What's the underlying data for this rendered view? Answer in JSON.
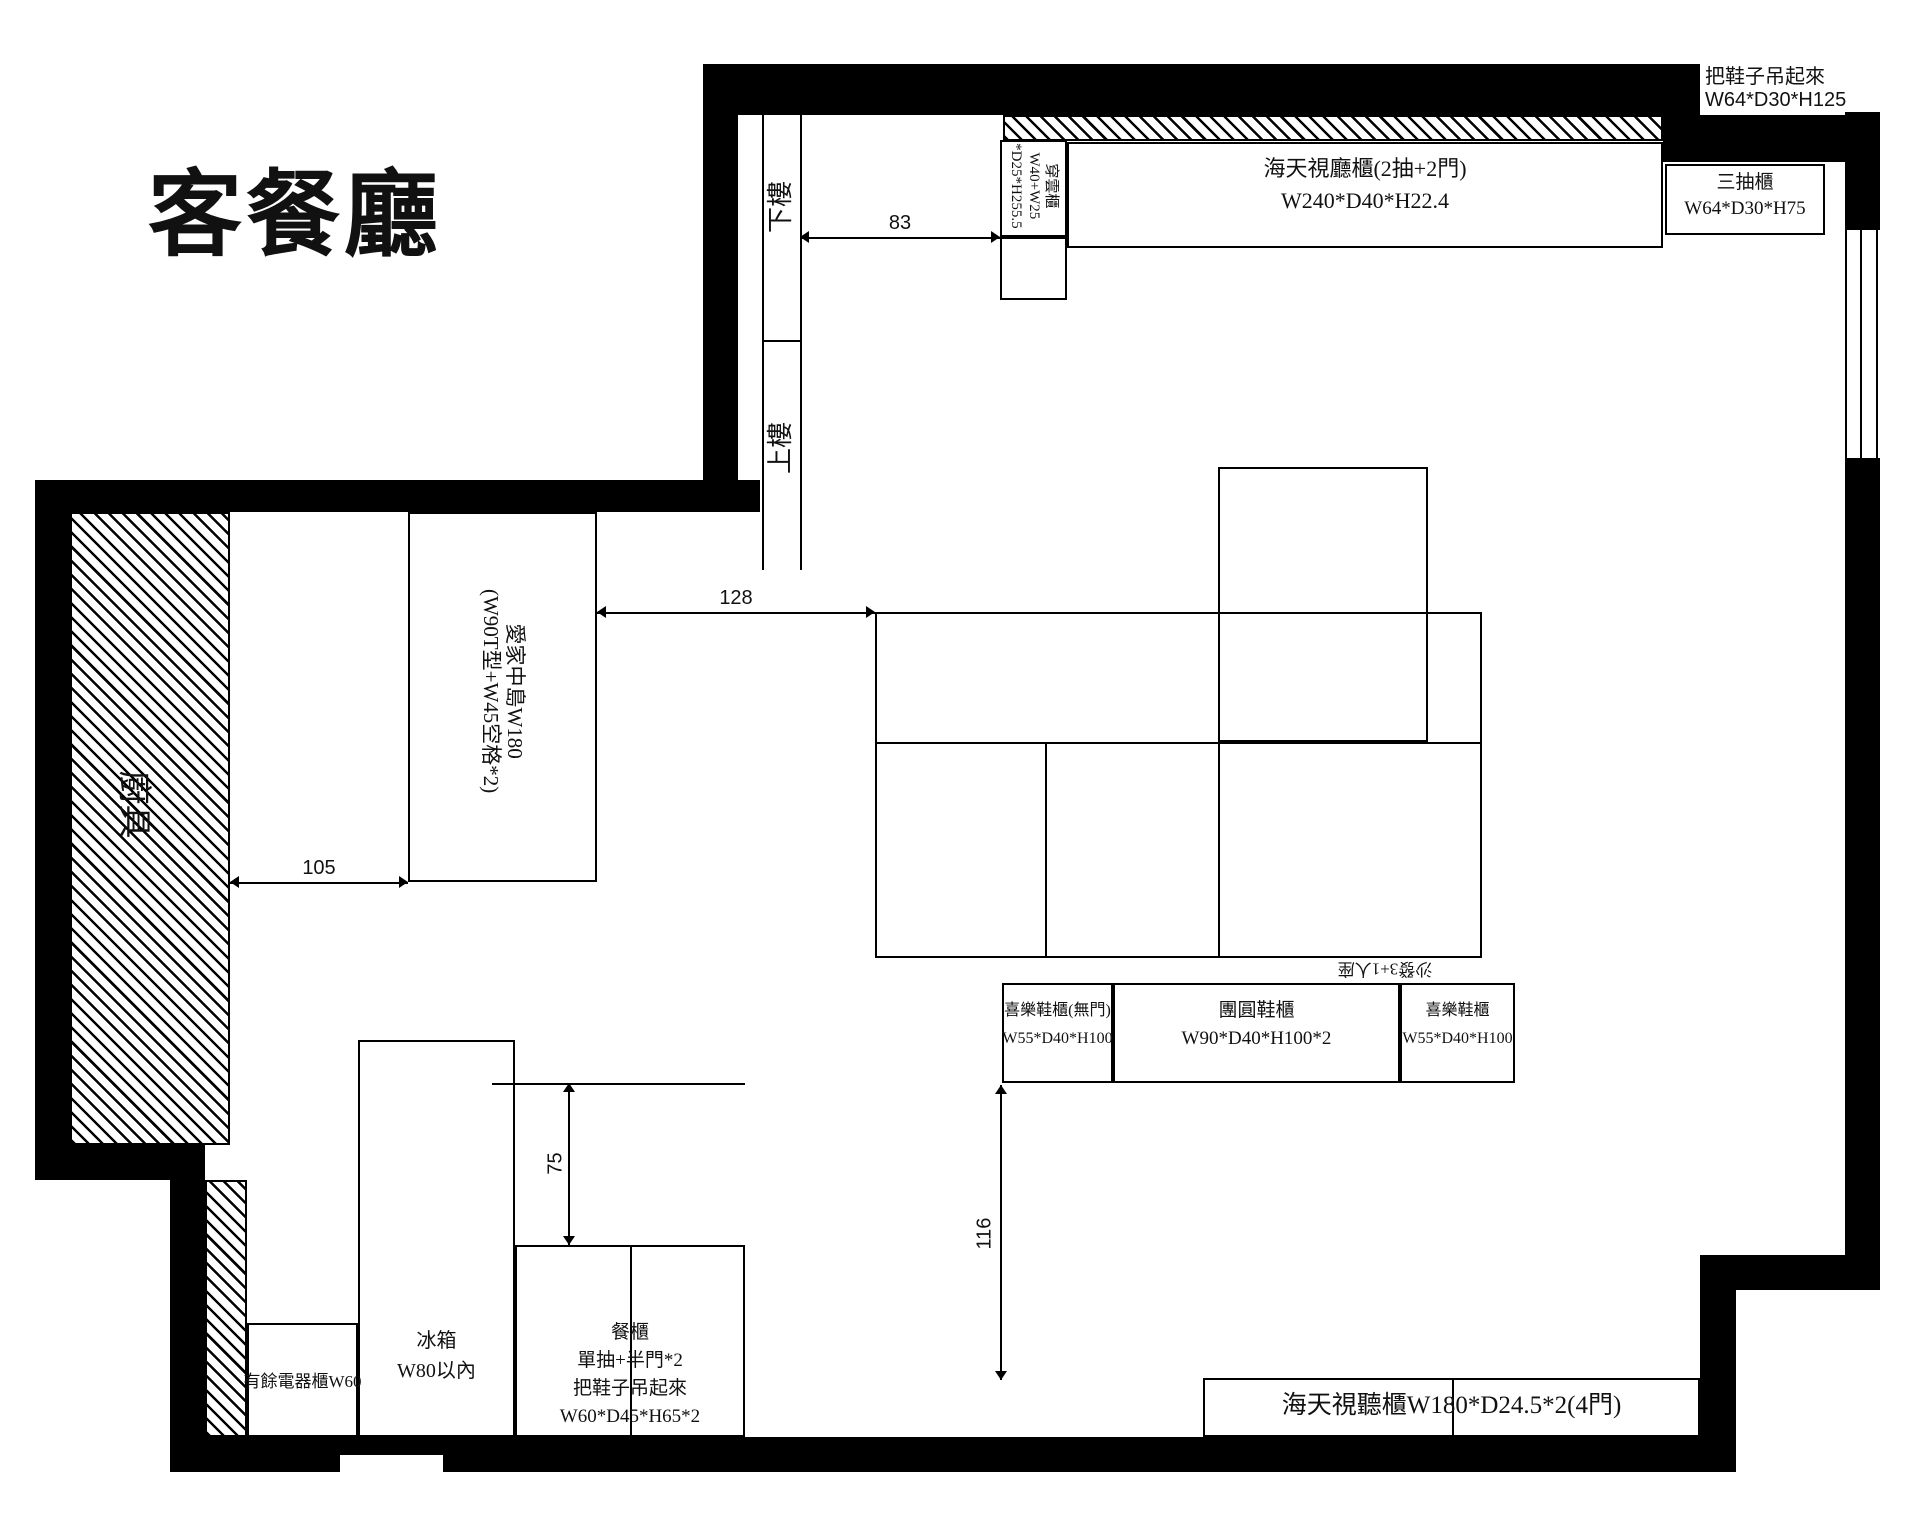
{
  "title": "客餐廳",
  "colors": {
    "wall": "#000000",
    "line": "#111111",
    "background": "#ffffff"
  },
  "entry_area": {
    "stairs_down": "下樓",
    "stairs_up": "上樓",
    "tall_cabinet": {
      "name": "穿雲櫃",
      "dim1": "W40+W25",
      "dim2": "*D25*H255.5"
    },
    "av_cabinet_top": {
      "line1": "海天視廳櫃(2抽+2門)",
      "line2": "W240*D40*H22.4"
    },
    "three_drawer_cabinet": {
      "line1": "三抽櫃",
      "line2": "W64*D30*H75"
    },
    "hang_shoes_note": {
      "line1": "把鞋子吊起來",
      "line2": "W64*D30*H125"
    }
  },
  "kitchen_area": {
    "kitchen_fixtures": "廚具",
    "island": {
      "line1": "愛家中島W180",
      "line2": "(W90T型+W45空格*2)"
    },
    "appliance_cabinet": "有餘電器櫃W60",
    "fridge": {
      "line1": "冰箱",
      "line2": "W80以內"
    },
    "sideboard": {
      "line1": "餐櫃",
      "line2": "單抽+半門*2",
      "line3": "把鞋子吊起來",
      "line4": "W60*D45*H65*2"
    }
  },
  "living_area": {
    "sofa": "沙發3+1人座",
    "shoe_cabinet_left": {
      "line1": "喜樂鞋櫃(無門)",
      "line2": "W55*D40*H100"
    },
    "shoe_cabinet_center": {
      "line1": "團圓鞋櫃",
      "line2": "W90*D40*H100*2"
    },
    "shoe_cabinet_right": {
      "line1": "喜樂鞋櫃",
      "line2": "W55*D40*H100"
    },
    "av_cabinet_bottom": "海天視聽櫃W180*D24.5*2(4門)"
  },
  "dimensions": {
    "d83": "83",
    "d105": "105",
    "d128": "128",
    "d75": "75",
    "d116": "116"
  }
}
